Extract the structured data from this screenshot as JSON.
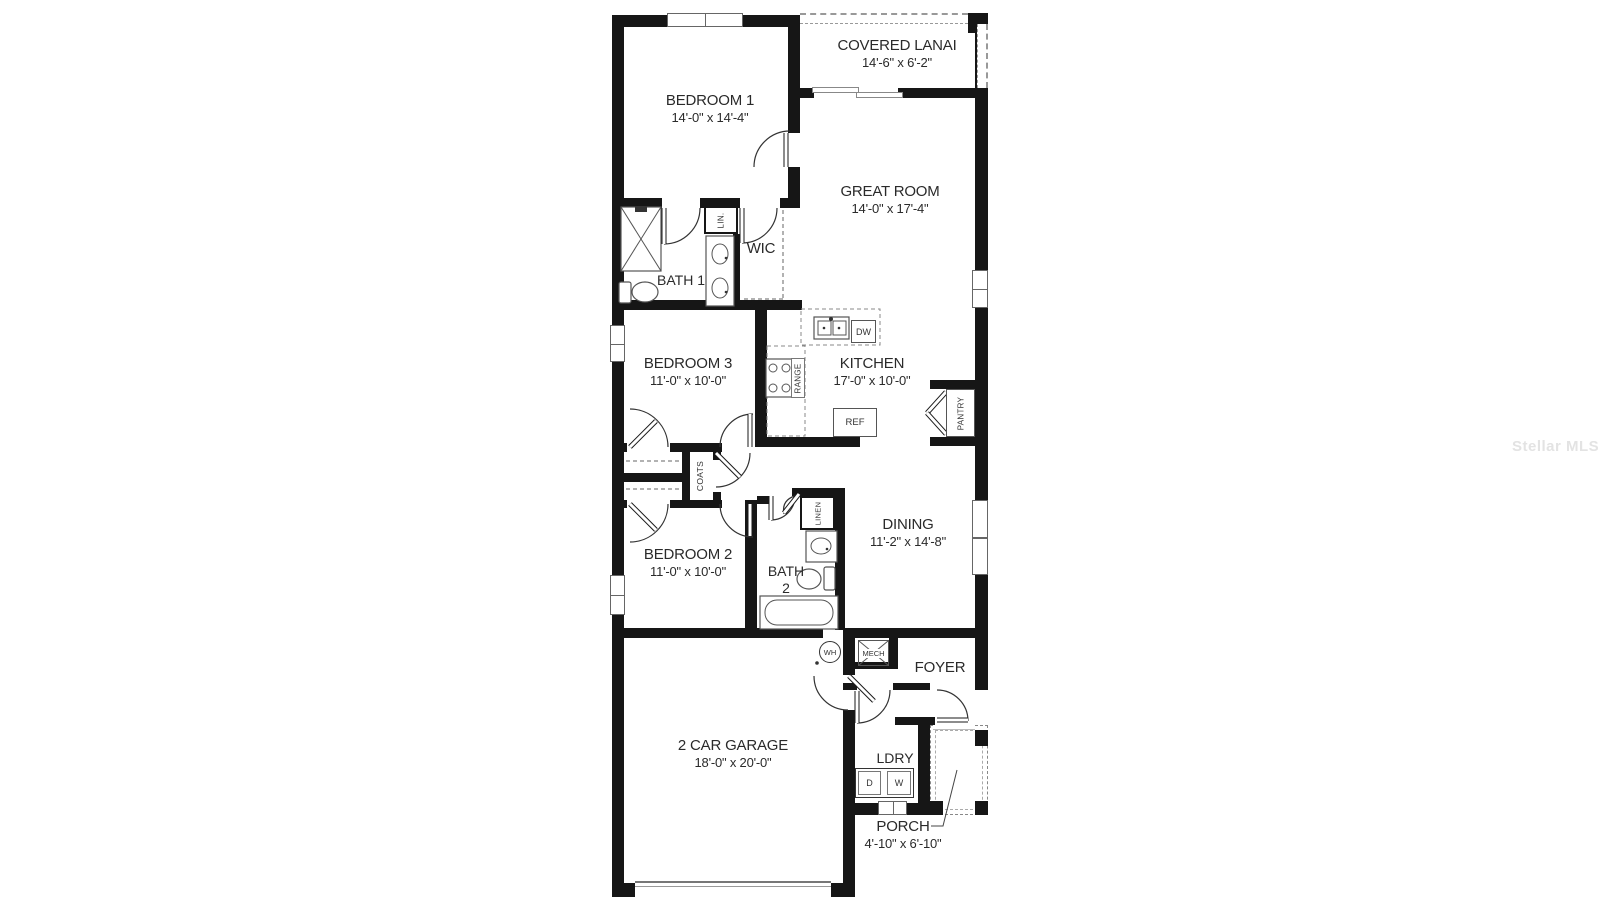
{
  "watermark": "Stellar MLS",
  "rooms": {
    "covered_lanai": {
      "label": "COVERED LANAI",
      "dims": "14'-6\" x 6'-2\""
    },
    "bedroom1": {
      "label": "BEDROOM 1",
      "dims": "14'-0\" x 14'-4\""
    },
    "great_room": {
      "label": "GREAT ROOM",
      "dims": "14'-0\" x 17'-4\""
    },
    "bath1": {
      "label": "BATH 1"
    },
    "wic": {
      "label": "WIC"
    },
    "bedroom3": {
      "label": "BEDROOM 3",
      "dims": "11'-0\" x 10'-0\""
    },
    "kitchen": {
      "label": "KITCHEN",
      "dims": "17'-0\" x 10'-0\""
    },
    "bedroom2": {
      "label": "BEDROOM 2",
      "dims": "11'-0\" x 10'-0\""
    },
    "bath2": {
      "line1": "BATH",
      "line2": "2"
    },
    "dining": {
      "label": "DINING",
      "dims": "11'-2\" x 14'-8\""
    },
    "foyer": {
      "label": "FOYER"
    },
    "garage": {
      "label": "2 CAR GARAGE",
      "dims": "18'-0\" x 20'-0\""
    },
    "ldry": {
      "label": "LDRY"
    },
    "porch": {
      "label": "PORCH",
      "dims": "4'-10\" x 6'-10\""
    }
  },
  "closets": {
    "lin": "LIN.",
    "coats": "COATS",
    "linen": "LINEN",
    "pantry": "PANTRY"
  },
  "fixtures": {
    "range": "RANGE",
    "dw": "DW",
    "ref": "REF",
    "wh": "WH",
    "mech": "MECH",
    "dryer": "D",
    "washer": "W"
  }
}
